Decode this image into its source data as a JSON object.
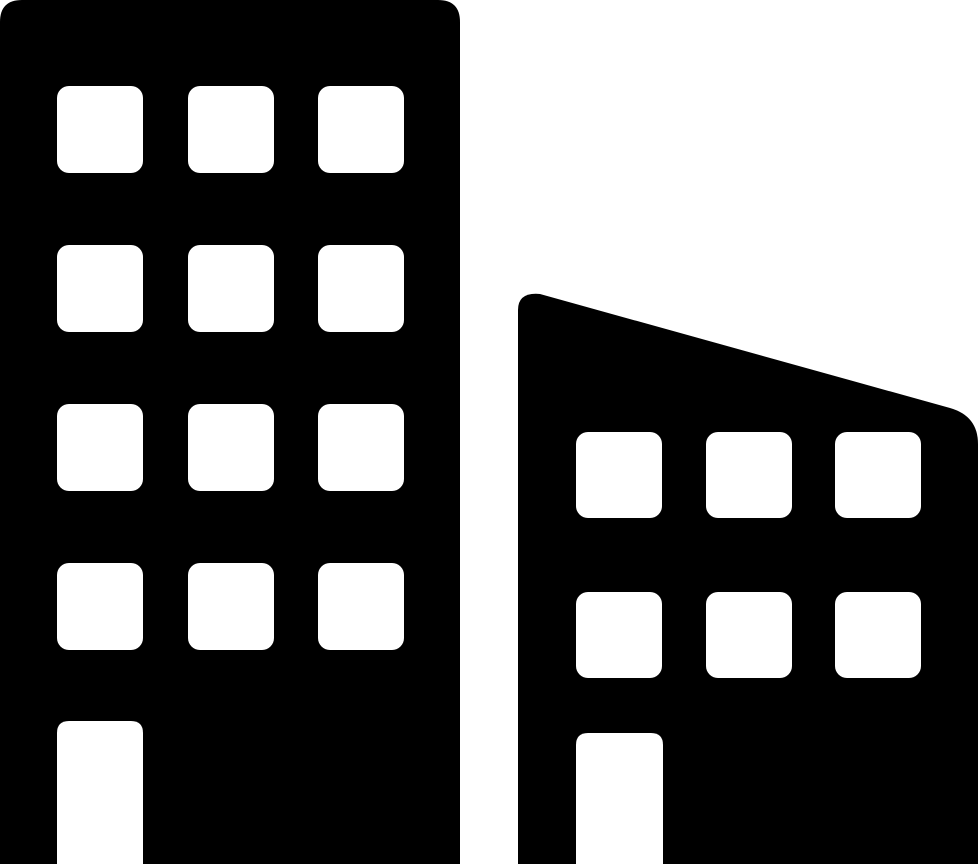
{
  "page": {
    "background_color": "#ffffff",
    "content_type": "icon-glyph",
    "subject": "two city buildings silhouette"
  },
  "icon": {
    "name": "city-buildings-icon",
    "fill_color": "#000000",
    "cutout_color": "#ffffff",
    "canvas": {
      "width": 980,
      "height": 866
    },
    "left_building": {
      "x": 0,
      "y": 0,
      "width": 460,
      "height": 864,
      "top_corner_radius": 22,
      "windows": {
        "columns_x": [
          57,
          188,
          318
        ],
        "rows_y": [
          86,
          245,
          404,
          563
        ],
        "width": 86,
        "height": 87,
        "corner_radius": 12
      },
      "door": {
        "x": 57,
        "y": 721,
        "width": 86,
        "height": 143,
        "top_corner_radius": 12
      }
    },
    "right_building": {
      "left_x": 518,
      "right_x": 978,
      "bottom_y": 864,
      "roof_start": {
        "x": 540,
        "y": 294
      },
      "roof_end": {
        "x": 950,
        "y": 408
      },
      "top_left_corner_radius": 16,
      "top_right_corner_radius": 28,
      "windows": {
        "columns_x": [
          576,
          706,
          835
        ],
        "rows_y": [
          432,
          592
        ],
        "width": 86,
        "height": 86,
        "corner_radius": 12
      },
      "door": {
        "x": 576,
        "y": 733,
        "width": 87,
        "height": 131,
        "top_corner_radius": 12
      }
    }
  }
}
